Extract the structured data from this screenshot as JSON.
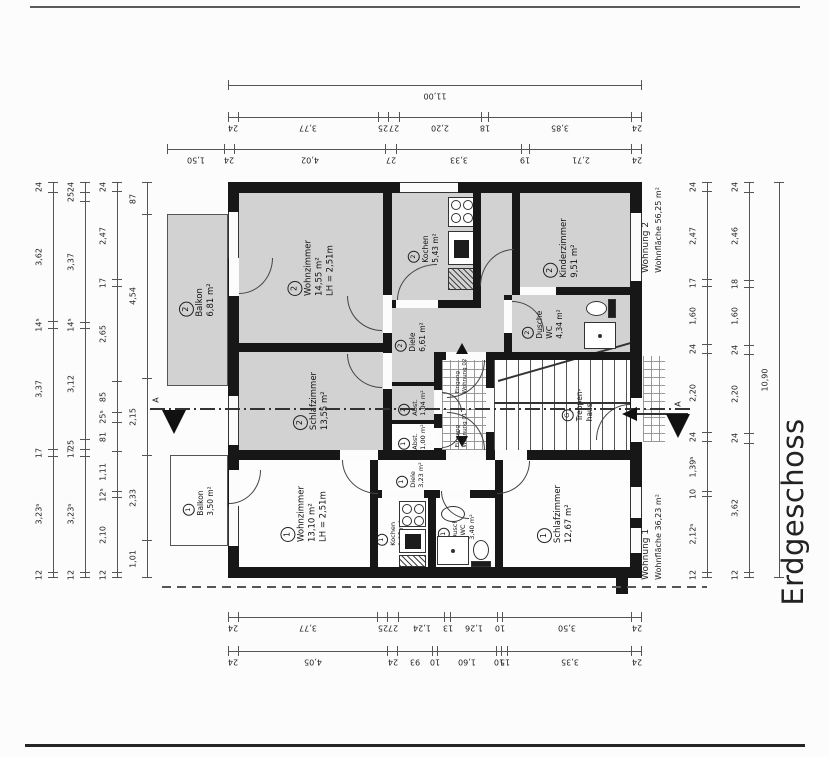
{
  "drawing": {
    "floor_label": "Erdgeschoss",
    "section_marker": "A",
    "colors": {
      "wall": "#171717",
      "room_fill": "#d2d2d2",
      "line": "#333333",
      "paper": "#fcfcfc"
    }
  },
  "apartments": {
    "w2": {
      "name": "Wohnung 2",
      "area": "Wohnfläche 56,25 m²"
    },
    "w1": {
      "name": "Wohnung 1",
      "area": "Wohnfläche 36,23 m²"
    }
  },
  "rooms": {
    "w2_wohnzimmer": {
      "unit": "2",
      "name": "Wohnzimmer",
      "area": "14,55 m²",
      "extra": "LH = 2,51m"
    },
    "w2_schlafzimmer": {
      "unit": "2",
      "name": "Schlafzimmer",
      "area": "13,55 m²"
    },
    "w2_kochen": {
      "unit": "2",
      "name": "Kochen",
      "area": "5,43 m²"
    },
    "w2_diele": {
      "unit": "2",
      "name": "Diele",
      "area": "6,61 m²"
    },
    "w2_kinderzimmer": {
      "unit": "2",
      "name": "Kinderzimmer",
      "area": "9,51 m²"
    },
    "w2_dusche": {
      "unit": "2",
      "name": "Dusche",
      "name2": "WC",
      "area": "4,34 m²"
    },
    "w2_abst": {
      "unit": "2",
      "name": "Abst.",
      "area": "1,04 m²"
    },
    "w2_balkon": {
      "unit": "2",
      "name": "Balkon",
      "area": "6,81 m²"
    },
    "w1_wohnzimmer": {
      "unit": "1",
      "name": "Wohnzimmer",
      "area": "13,10 m²",
      "extra": "LH = 2,51m"
    },
    "w1_kochen": {
      "unit": "1",
      "name": "Kochen",
      "area": "1,95 m²"
    },
    "w1_dusche": {
      "unit": "1",
      "name": "Dusche",
      "name2": "/ WC",
      "area": "3,40 m²"
    },
    "w1_diele": {
      "unit": "1",
      "name": "Diele",
      "area": "3,23 m²"
    },
    "w1_abst": {
      "unit": "1",
      "name": "Abst.",
      "area": "1,00 m²"
    },
    "w1_schlafzimmer": {
      "unit": "1",
      "name": "Schlafzimmer",
      "area": "12,67 m²"
    },
    "w1_balkon": {
      "unit": "1",
      "name": "Balkon",
      "area": "3,50 m²"
    },
    "treppenhaus": {
      "unit": "G",
      "name": "Treppen-",
      "name2": "haus"
    }
  },
  "entrances": {
    "e02": {
      "line1": "Eingang",
      "line2": "Wohnung 02"
    },
    "e01": {
      "line1": "Eingang",
      "line2": "Wohnung 01"
    }
  },
  "dimensions": {
    "top_overall": [
      "11,00"
    ],
    "top_row2": [
      "24",
      "3,77",
      "25",
      "27",
      "2,20",
      "18",
      "3,85",
      "24"
    ],
    "top_row3": [
      "1,50",
      "24",
      "4,02",
      "27",
      "3,33",
      "19",
      "2,71",
      "24"
    ],
    "bottom_row1": [
      "24",
      "3,77",
      "25",
      "27",
      "1,24",
      "13",
      "1,26",
      "10",
      "3,50",
      "24"
    ],
    "bottom_row2": [
      "24",
      "4,05",
      "24",
      "93",
      "10",
      "1,60",
      "10",
      "15",
      "3,35",
      "24"
    ],
    "left_1": [
      "24",
      "3,62",
      "14⁵",
      "3,37",
      "17",
      "3,23⁵",
      "12"
    ],
    "left_2": [
      "24",
      "25",
      "3,37",
      "14⁵",
      "3,12",
      "25",
      "17",
      "3,23⁵",
      "12"
    ],
    "left_3": [
      "24",
      "2,47",
      "17",
      "2,65",
      "85",
      "25⁵",
      "81",
      "1,11",
      "12⁵",
      "2,10",
      "12"
    ],
    "left_4": [
      "87",
      "4,54",
      "2,15",
      "2,33",
      "1,01"
    ],
    "right_1": [
      "24",
      "2,47",
      "17",
      "1,60",
      "24",
      "2,20",
      "24",
      "1,39⁵",
      "10",
      "2,12⁵",
      "12"
    ],
    "right_2": [
      "24",
      "2,46",
      "18",
      "1,60",
      "24",
      "2,20",
      "24",
      "3,62",
      "12"
    ],
    "right_overall": [
      "10,90"
    ]
  }
}
